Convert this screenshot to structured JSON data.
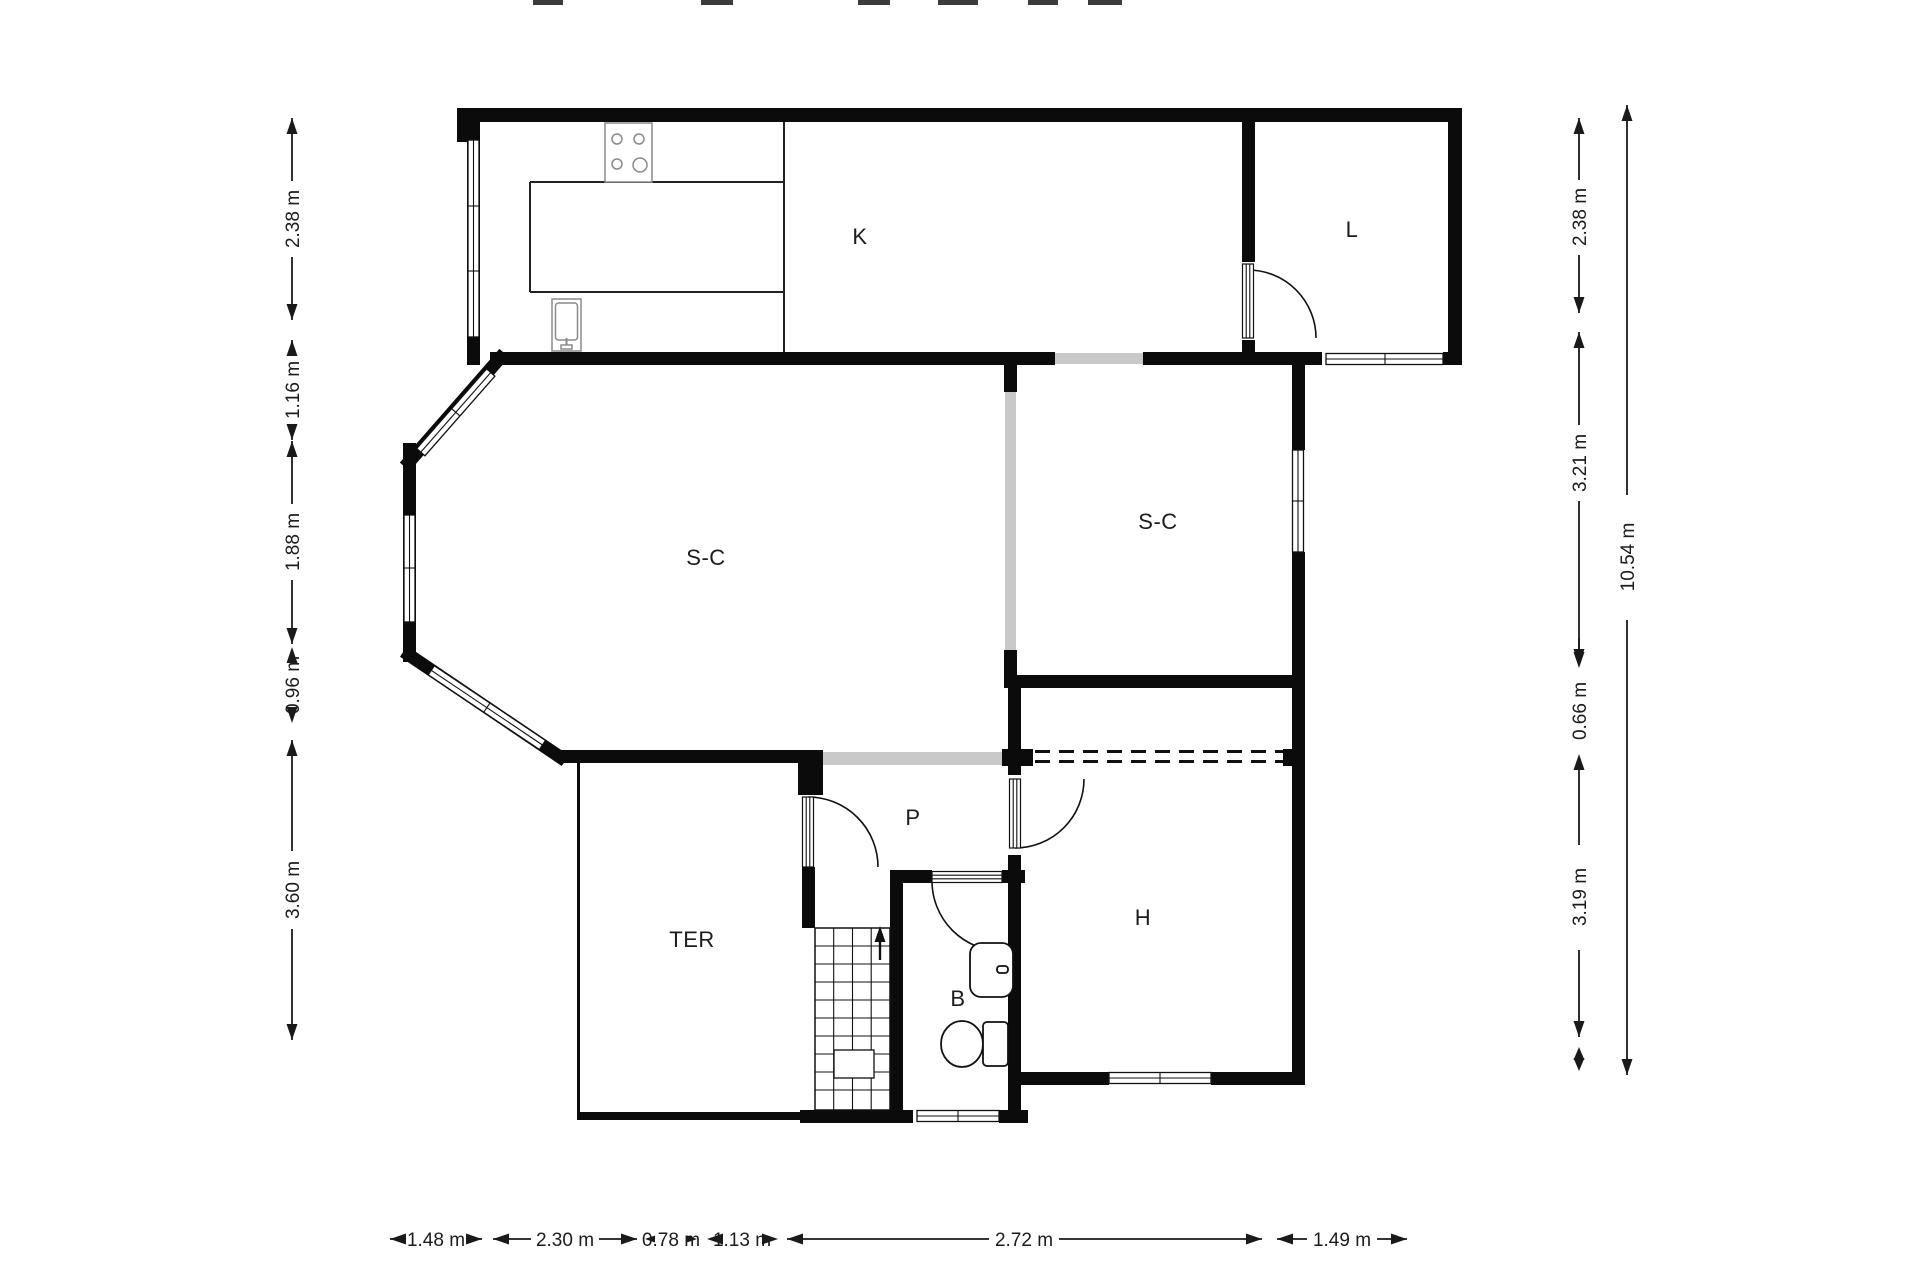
{
  "plan": {
    "type": "floor-plan",
    "background": "#ffffff",
    "wall_color": "#0b0b0b",
    "opening_color": "#c9c9c9"
  },
  "rooms": [
    {
      "id": "kitchen",
      "label": "K"
    },
    {
      "id": "laundry",
      "label": "L"
    },
    {
      "id": "living-left",
      "label": "S-C"
    },
    {
      "id": "living-right",
      "label": "S-C"
    },
    {
      "id": "hallway",
      "label": "P"
    },
    {
      "id": "terrace",
      "label": "TER"
    },
    {
      "id": "bathroom",
      "label": "B"
    },
    {
      "id": "bedroom",
      "label": "H"
    }
  ],
  "dimensions": {
    "left": [
      "2.38 m",
      "1.16 m",
      "1.88 m",
      "0.96 m",
      "3.60 m"
    ],
    "right_inner": [
      "2.38 m",
      "3.21 m",
      "0.66 m",
      "3.19 m"
    ],
    "right_outer": "10.54 m",
    "bottom": [
      "1.48 m",
      "2.30 m",
      "0.78 m",
      "1.13 m",
      "2.72 m",
      "1.49 m"
    ]
  }
}
